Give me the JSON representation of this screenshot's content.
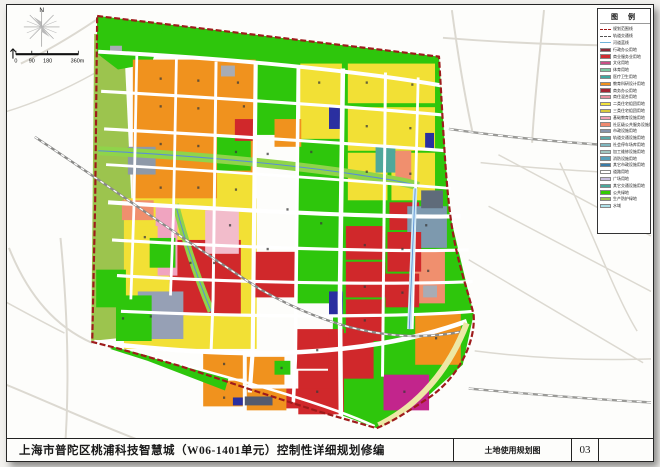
{
  "title_bar": {
    "project_title": "上海市普陀区桃浦科技智慧城（W06-1401单元）控制性详细规划修编",
    "sheet_name": "土地使用规划图",
    "sheet_no": "03"
  },
  "legend": {
    "title": "图 例",
    "items": [
      {
        "type": "line-red",
        "label": "规划范围线"
      },
      {
        "type": "line-gray",
        "label": "轨道交通线"
      },
      {
        "type": "line-blue",
        "label": "河道蓝线"
      },
      {
        "c": "#8E2B3A",
        "label": "行政办公用地"
      },
      {
        "c": "#D02C32",
        "label": "商业服务业用地"
      },
      {
        "c": "#C94F86",
        "label": "文化用地"
      },
      {
        "c": "#7CC9A2",
        "label": "体育用地"
      },
      {
        "c": "#3FA8A0",
        "label": "医疗卫生用地"
      },
      {
        "c": "#F0921E",
        "label": "教育科研设计用地"
      },
      {
        "c": "#A32634",
        "label": "商务办公用地"
      },
      {
        "c": "#E78F9E",
        "label": "商住混合用地"
      },
      {
        "c": "#F2E23C",
        "label": "二类住宅组团用地"
      },
      {
        "c": "#D9C93B",
        "label": "三类住宅组团用地"
      },
      {
        "c": "#F2A0B4",
        "label": "基础教育设施用地"
      },
      {
        "c": "#EF8A70",
        "label": "社区级公共服务设施用地"
      },
      {
        "c": "#8694AD",
        "label": "市政设施用地"
      },
      {
        "c": "#5AA8A8",
        "label": "轨道交通设施用地"
      },
      {
        "c": "#7FB6BF",
        "label": "社会停车场库用地"
      },
      {
        "c": "#9FC6C0",
        "label": "加工维修设施用地"
      },
      {
        "c": "#57A0BA",
        "label": "消防设施用地"
      },
      {
        "c": "#3A7CA8",
        "label": "其它市政设施用地"
      },
      {
        "c": "#FFFFFF",
        "label": "道路用地"
      },
      {
        "c": "#C9BFE0",
        "label": "广场用地"
      },
      {
        "c": "#4AA89B",
        "label": "其它交通设施用地"
      },
      {
        "c": "#33CC00",
        "label": "公共绿地"
      },
      {
        "c": "#9CC44E",
        "label": "生产防护绿地"
      },
      {
        "c": "#AEE0E8",
        "label": "水域"
      }
    ]
  },
  "map": {
    "colors": {
      "boundary": "#9E1B1B",
      "green": "#2EC60C",
      "olive": "#9CC44E",
      "orange": "#F0921E",
      "yellow": "#F2E035",
      "red": "#D0282B",
      "water": "#5A8FD4"
    },
    "compass_label": "N",
    "scale_labels": [
      "0",
      "90",
      "180",
      "360m"
    ],
    "ops": [
      {
        "d": "M20,62 C50,48 75,32 96,18",
        "c": "#DCD9D1",
        "w": 2
      },
      {
        "d": "M0,112 C35,102 65,88 94,72",
        "c": "#DCD9D1",
        "w": 1.5
      },
      {
        "d": "M60,238 C66,300 70,380 64,458",
        "c": "#DCD9D1",
        "w": 2
      },
      {
        "d": "M8,248 C28,298 56,328 92,344",
        "c": "#DCD9D1",
        "w": 2
      },
      {
        "d": "M0,384 C45,402 95,426 155,448",
        "c": "#DCD9D1",
        "w": 2
      },
      {
        "d": "M0,300 C22,312 44,324 64,334",
        "c": "#DCD9D1",
        "w": 1.5
      },
      {
        "d": "M455,8 C462,60 468,95 476,132",
        "c": "#DCD9D1",
        "w": 2
      },
      {
        "d": "M548,8 C543,60 538,100 536,142",
        "c": "#DCD9D1",
        "w": 2
      },
      {
        "d": "M446,36 C520,42 600,44 656,44",
        "c": "#DCD9D1",
        "w": 2
      },
      {
        "d": "M484,162 C560,170 620,172 656,174",
        "c": "#DCD9D1",
        "w": 1.5
      },
      {
        "d": "M492,206 L656,292",
        "c": "#DCD9D1",
        "w": 1.5
      },
      {
        "d": "M472,260 L648,364",
        "c": "#DCD9D1",
        "w": 1.5
      },
      {
        "d": "M502,154 L656,236",
        "c": "#DCD9D1",
        "w": 1.5
      },
      {
        "d": "M564,162 C600,240 622,300 642,332",
        "c": "#DCD9D1",
        "w": 1.5
      },
      {
        "d": "M380,441 C300,446 200,452 110,458",
        "c": "#DCD9D1",
        "w": 1.5
      },
      {
        "d": "M478,352 C540,360 600,362 656,360",
        "c": "#DCD9D1",
        "w": 1.5
      },
      {
        "d": "M452,128 C520,138 600,144 656,147",
        "c": "#9A9A97",
        "w": 2.4
      },
      {
        "d": "M452,128 C520,138 600,144 656,147",
        "c": "#FFFFFF",
        "w": 1.2,
        "dash": "5,5"
      },
      {
        "d": "M472,390 C560,398 620,402 656,404",
        "c": "#9A9A97",
        "w": 2.4
      },
      {
        "d": "M472,390 C560,398 620,402 656,404",
        "c": "#FFFFFF",
        "w": 1.2,
        "dash": "5,5"
      },
      {
        "k": "poly",
        "pts": "94,32 124,38 132,210 129,338 91,342",
        "f": "#9CC44E"
      },
      {
        "k": "poly",
        "pts": "97,14 442,55 444,84 300,66 160,52 97,48",
        "f": "#2EC60C"
      },
      {
        "k": "poly",
        "pts": "97,14 165,22 152,62 118,68 97,52",
        "f": "#2EC60C"
      },
      {
        "k": "poly",
        "pts": "340,64 444,84 452,210 477,315 466,366 428,400 379,430 333,413 337,230",
        "f": "#2EC60C"
      },
      {
        "k": "rect",
        "x": 253,
        "y": 58,
        "w": 48,
        "h": 76,
        "f": "#2EC60C"
      },
      {
        "k": "rect",
        "x": 298,
        "y": 118,
        "w": 54,
        "h": 186,
        "f": "#2EC60C"
      },
      {
        "k": "rect",
        "x": 133,
        "y": 58,
        "w": 124,
        "h": 146,
        "f": "#F0921E"
      },
      {
        "k": "rect",
        "x": 124,
        "y": 198,
        "w": 134,
        "h": 152,
        "f": "#F2E035"
      },
      {
        "k": "rect",
        "x": 350,
        "y": 62,
        "w": 88,
        "h": 40,
        "f": "#F2E035"
      },
      {
        "k": "rect",
        "x": 350,
        "y": 106,
        "w": 88,
        "h": 44,
        "f": "#F2E035"
      },
      {
        "k": "rect",
        "x": 350,
        "y": 152,
        "w": 40,
        "h": 48,
        "f": "#F2E035"
      },
      {
        "k": "rect",
        "x": 394,
        "y": 152,
        "w": 44,
        "h": 48,
        "f": "#F2E035"
      },
      {
        "k": "rect",
        "x": 302,
        "y": 62,
        "w": 42,
        "h": 76,
        "f": "#F2E035"
      },
      {
        "k": "rect",
        "x": 276,
        "y": 118,
        "w": 27,
        "h": 28,
        "f": "#F0921E"
      },
      {
        "k": "rect",
        "x": 218,
        "y": 134,
        "w": 34,
        "h": 36,
        "f": "#2EC60C"
      },
      {
        "k": "rect",
        "x": 218,
        "y": 172,
        "w": 36,
        "h": 30,
        "f": "#F2E035"
      },
      {
        "k": "rect",
        "x": 236,
        "y": 118,
        "w": 22,
        "h": 22,
        "f": "#D0282B"
      },
      {
        "k": "rect",
        "x": 128,
        "y": 146,
        "w": 28,
        "h": 28,
        "f": "#8E99A8"
      },
      {
        "k": "rect",
        "x": 222,
        "y": 64,
        "w": 14,
        "h": 11,
        "f": "#A8ACB4"
      },
      {
        "k": "rect",
        "x": 110,
        "y": 44,
        "w": 12,
        "h": 8,
        "f": "#A8ACB4"
      },
      {
        "k": "rect",
        "x": 331,
        "y": 106,
        "w": 11,
        "h": 22,
        "f": "#2A2FA0"
      },
      {
        "k": "rect",
        "x": 428,
        "y": 132,
        "w": 9,
        "h": 17,
        "f": "#2A2FA0"
      },
      {
        "k": "rect",
        "x": 331,
        "y": 292,
        "w": 14,
        "h": 26,
        "f": "#2A2FA0"
      },
      {
        "k": "rect",
        "x": 170,
        "y": 240,
        "w": 72,
        "h": 76,
        "f": "#D0282B"
      },
      {
        "k": "rect",
        "x": 256,
        "y": 252,
        "w": 42,
        "h": 46,
        "f": "#D0282B"
      },
      {
        "k": "rect",
        "x": 156,
        "y": 206,
        "w": 22,
        "h": 70,
        "f": "#F0A4C0"
      },
      {
        "k": "rect",
        "x": 206,
        "y": 210,
        "w": 34,
        "h": 44,
        "f": "#F2BCCB"
      },
      {
        "k": "rect",
        "x": 122,
        "y": 200,
        "w": 32,
        "h": 20,
        "f": "#F08F6E"
      },
      {
        "k": "rect",
        "x": 126,
        "y": 226,
        "w": 32,
        "h": 50,
        "f": "#F2E035"
      },
      {
        "k": "rect",
        "x": 138,
        "y": 292,
        "w": 46,
        "h": 48,
        "f": "#96A0B5"
      },
      {
        "k": "rect",
        "x": 96,
        "y": 270,
        "w": 30,
        "h": 38,
        "f": "#2EC60C"
      },
      {
        "k": "rect",
        "x": 116,
        "y": 296,
        "w": 36,
        "h": 46,
        "f": "#2EC60C"
      },
      {
        "k": "rect",
        "x": 150,
        "y": 238,
        "w": 26,
        "h": 30,
        "f": "#2EC60C"
      },
      {
        "k": "rect",
        "x": 378,
        "y": 146,
        "w": 20,
        "h": 26,
        "f": "#4FA89B"
      },
      {
        "k": "rect",
        "x": 398,
        "y": 150,
        "w": 16,
        "h": 30,
        "f": "#F08F6E"
      },
      {
        "k": "rect",
        "x": 392,
        "y": 202,
        "w": 30,
        "h": 28,
        "f": "#D0282B"
      },
      {
        "k": "rect",
        "x": 410,
        "y": 206,
        "w": 40,
        "h": 42,
        "f": "#7D99AE"
      },
      {
        "k": "rect",
        "x": 424,
        "y": 190,
        "w": 22,
        "h": 18,
        "f": "#5F6B7A"
      },
      {
        "k": "rect",
        "x": 412,
        "y": 252,
        "w": 36,
        "h": 52,
        "f": "#F08F6E"
      },
      {
        "k": "rect",
        "x": 418,
        "y": 314,
        "w": 46,
        "h": 52,
        "f": "#F0921E"
      },
      {
        "k": "rect",
        "x": 386,
        "y": 376,
        "w": 46,
        "h": 36,
        "f": "#C2258C"
      },
      {
        "k": "rect",
        "x": 426,
        "y": 286,
        "w": 14,
        "h": 12,
        "f": "#A8ACB4"
      },
      {
        "k": "rect",
        "x": 348,
        "y": 226,
        "w": 40,
        "h": 34,
        "f": "#D0282B"
      },
      {
        "k": "rect",
        "x": 390,
        "y": 232,
        "w": 34,
        "h": 40,
        "f": "#D0282B"
      },
      {
        "k": "rect",
        "x": 348,
        "y": 262,
        "w": 40,
        "h": 36,
        "f": "#D0282B"
      },
      {
        "k": "rect",
        "x": 388,
        "y": 274,
        "w": 34,
        "h": 34,
        "f": "#D0282B"
      },
      {
        "k": "rect",
        "x": 348,
        "y": 300,
        "w": 38,
        "h": 42,
        "f": "#D0282B"
      },
      {
        "k": "rect",
        "x": 296,
        "y": 330,
        "w": 50,
        "h": 40,
        "f": "#D0282B"
      },
      {
        "k": "rect",
        "x": 300,
        "y": 372,
        "w": 46,
        "h": 44,
        "f": "#D0282B"
      },
      {
        "k": "rect",
        "x": 330,
        "y": 334,
        "w": 46,
        "h": 46,
        "f": "#D0282B"
      },
      {
        "k": "rect",
        "x": 282,
        "y": 390,
        "w": 56,
        "h": 20,
        "f": "#D0282B"
      },
      {
        "k": "rect",
        "x": 204,
        "y": 352,
        "w": 40,
        "h": 28,
        "f": "#F0921E"
      },
      {
        "k": "rect",
        "x": 204,
        "y": 382,
        "w": 40,
        "h": 26,
        "f": "#F0921E"
      },
      {
        "k": "rect",
        "x": 248,
        "y": 358,
        "w": 38,
        "h": 28,
        "f": "#F0921E"
      },
      {
        "k": "rect",
        "x": 248,
        "y": 390,
        "w": 40,
        "h": 22,
        "f": "#F0921E"
      },
      {
        "k": "rect",
        "x": 276,
        "y": 362,
        "w": 16,
        "h": 14,
        "f": "#2EC60C"
      },
      {
        "k": "rect",
        "x": 246,
        "y": 398,
        "w": 28,
        "h": 9,
        "f": "#555B6E"
      },
      {
        "k": "rect",
        "x": 234,
        "y": 399,
        "w": 10,
        "h": 8,
        "f": "#2A2FA0"
      },
      {
        "k": "poly",
        "pts": "114,348 230,378 226,392 148,362 110,350",
        "f": "#2EC60C"
      },
      {
        "d": "M98,150 C200,155 290,164 352,173 C392,179 412,182 421,186",
        "c": "#8FD44A",
        "w": 9
      },
      {
        "d": "M98,150 C200,155 290,164 352,173 C392,179 412,182 421,186",
        "c": "#5A8FD4",
        "w": 1.1
      },
      {
        "d": "M176,204 C186,242 198,278 212,312",
        "c": "#8FD44A",
        "w": 7
      },
      {
        "d": "M176,204 C186,242 198,278 212,312",
        "c": "#5A8FD4",
        "w": 1
      },
      {
        "d": "M98,50 C230,57 350,68 444,84",
        "c": "#FFFFFF",
        "w": 4
      },
      {
        "d": "M101,90 C240,98 360,106 447,114",
        "c": "#FFFFFF",
        "w": 3.2
      },
      {
        "d": "M104,128 C250,136 370,144 450,150",
        "c": "#FFFFFF",
        "w": 3.2
      },
      {
        "d": "M106,164 C260,173 380,182 454,188",
        "c": "#FFFFFF",
        "w": 2.8
      },
      {
        "d": "M108,202 C270,212 400,218 464,216",
        "c": "#FFFFFF",
        "w": 4.2
      },
      {
        "d": "M112,240 C280,250 420,252 472,250",
        "c": "#FFFFFF",
        "w": 3.2
      },
      {
        "d": "M117,276 C290,286 430,284 476,282",
        "c": "#FFFFFF",
        "w": 3.2
      },
      {
        "d": "M121,312 C300,320 430,316 477,312",
        "c": "#FFFFFF",
        "w": 3.2
      },
      {
        "d": "M94,343 C250,362 370,358 470,322",
        "c": "#FFFFFF",
        "w": 4.6
      },
      {
        "d": "M150,357 C250,384 330,406 377,428",
        "c": "#FFFFFF",
        "w": 2.6
      },
      {
        "d": "M137,54 L134,210 L131,300",
        "c": "#FFFFFF",
        "w": 2.8
      },
      {
        "d": "M177,57 L174,214 L171,296",
        "c": "#FFFFFF",
        "w": 2.8
      },
      {
        "d": "M217,60 L214,300 L212,352",
        "c": "#FFFFFF",
        "w": 3
      },
      {
        "d": "M257,62 L254,352 L251,394",
        "c": "#FFFFFF",
        "w": 4.2
      },
      {
        "d": "M300,65 L297,360 L295,404",
        "c": "#FFFFFF",
        "w": 3.6
      },
      {
        "d": "M345,67 L342,300 L343,422",
        "c": "#FFFFFF",
        "w": 4.6
      },
      {
        "d": "M388,71 L385,378",
        "c": "#FFFFFF",
        "w": 3
      },
      {
        "d": "M421,76 L415,330",
        "c": "#FFFFFF",
        "w": 2.8
      },
      {
        "d": "M418,188 L412,330",
        "c": "#CDE8F5",
        "w": 4.4
      },
      {
        "d": "M418,188 L412,330",
        "c": "#5A8FD4",
        "w": 0.9
      },
      {
        "d": "M34,136 C110,186 190,244 262,290 C332,330 400,346 468,332",
        "c": "#8A8A88",
        "w": 2.4
      },
      {
        "d": "M34,136 C110,186 190,244 262,290 C332,330 400,346 468,332",
        "c": "#FFFFFF",
        "w": 1.3,
        "dash": "4,4"
      },
      {
        "d": "M381,427 C420,408 452,372 470,324",
        "c": "#EDE8A6",
        "w": 6
      },
      {
        "d": "M97,14 L442,55 C446,120 448,172 453,212 C459,262 472,292 477,316 C479,347 458,383 429,401 C411,413 394,424 379,430 L320,413 L252,391 L180,367 L120,350 L92,343 L95,200 Z",
        "c": "#9E1B1B",
        "w": 2.2,
        "dash": "6,2.6"
      },
      {
        "d": "M41,7 L41,45",
        "c": "#999999",
        "w": 0.7
      },
      {
        "d": "M23,25 L59,25",
        "c": "#999999",
        "w": 0.7
      },
      {
        "d": "M29,13 L53,37",
        "c": "#AAAAAA",
        "w": 0.7
      },
      {
        "d": "M53,13 L29,37",
        "c": "#AAAAAA",
        "w": 0.7
      },
      {
        "d": "M26,19 L56,31",
        "c": "#BBBBBB",
        "w": 0.6
      },
      {
        "d": "M56,19 L26,31",
        "c": "#BBBBBB",
        "w": 0.6
      },
      {
        "k": "poly",
        "pts": "41,25 33,15 41,20",
        "f": "#B9B9B9"
      },
      {
        "k": "poly",
        "pts": "41,25 49,35 41,30",
        "f": "#B9B9B9"
      },
      {
        "k": "poly",
        "pts": "41,25 51,17 44,23",
        "f": "#C9C9C9"
      },
      {
        "k": "poly",
        "pts": "41,25 31,33 38,27",
        "f": "#C9C9C9"
      },
      {
        "k": "text",
        "x": 41,
        "y": 10,
        "t": "N",
        "s": 6.5,
        "c": "#111111",
        "anchor": "middle"
      },
      {
        "d": "M12,57 L12,47 M12,47 L9.5,50 M12,47 L14.5,50",
        "c": "#111111",
        "w": 1.1
      },
      {
        "d": "M15,52.5 L78,52.5",
        "c": "#111111",
        "w": 2.2
      },
      {
        "d": "M15,49 L15,53 M31,49 L31,53 M47,49 L47,53 M78,49 L78,53",
        "c": "#111111",
        "w": 0.8
      },
      {
        "k": "text",
        "x": 15,
        "y": 61,
        "t": "0",
        "s": 5.5,
        "c": "#111111",
        "anchor": "middle"
      },
      {
        "k": "text",
        "x": 31,
        "y": 61,
        "t": "90",
        "s": 5.5,
        "c": "#111111",
        "anchor": "middle"
      },
      {
        "k": "text",
        "x": 47,
        "y": 61,
        "t": "180",
        "s": 5.5,
        "c": "#111111",
        "anchor": "middle"
      },
      {
        "k": "text",
        "x": 84,
        "y": 61,
        "t": "360m",
        "s": 5.5,
        "c": "#111111",
        "anchor": "end"
      }
    ],
    "specks": [
      [
        160,
        76
      ],
      [
        198,
        78
      ],
      [
        238,
        80
      ],
      [
        160,
        104
      ],
      [
        198,
        106
      ],
      [
        244,
        104
      ],
      [
        160,
        142
      ],
      [
        198,
        144
      ],
      [
        236,
        150
      ],
      [
        160,
        186
      ],
      [
        198,
        186
      ],
      [
        236,
        188
      ],
      [
        320,
        80
      ],
      [
        368,
        80
      ],
      [
        414,
        82
      ],
      [
        368,
        124
      ],
      [
        412,
        126
      ],
      [
        368,
        170
      ],
      [
        412,
        172
      ],
      [
        312,
        150
      ],
      [
        322,
        222
      ],
      [
        230,
        224
      ],
      [
        144,
        236
      ],
      [
        190,
        262
      ],
      [
        214,
        262
      ],
      [
        366,
        244
      ],
      [
        404,
        248
      ],
      [
        366,
        286
      ],
      [
        404,
        292
      ],
      [
        366,
        320
      ],
      [
        224,
        364
      ],
      [
        282,
        368
      ],
      [
        224,
        398
      ],
      [
        318,
        350
      ],
      [
        318,
        392
      ],
      [
        406,
        392
      ],
      [
        438,
        338
      ],
      [
        428,
        224
      ],
      [
        430,
        270
      ],
      [
        150,
        316
      ],
      [
        122,
        318
      ],
      [
        268,
        248
      ],
      [
        268,
        152
      ],
      [
        288,
        208
      ]
    ]
  }
}
